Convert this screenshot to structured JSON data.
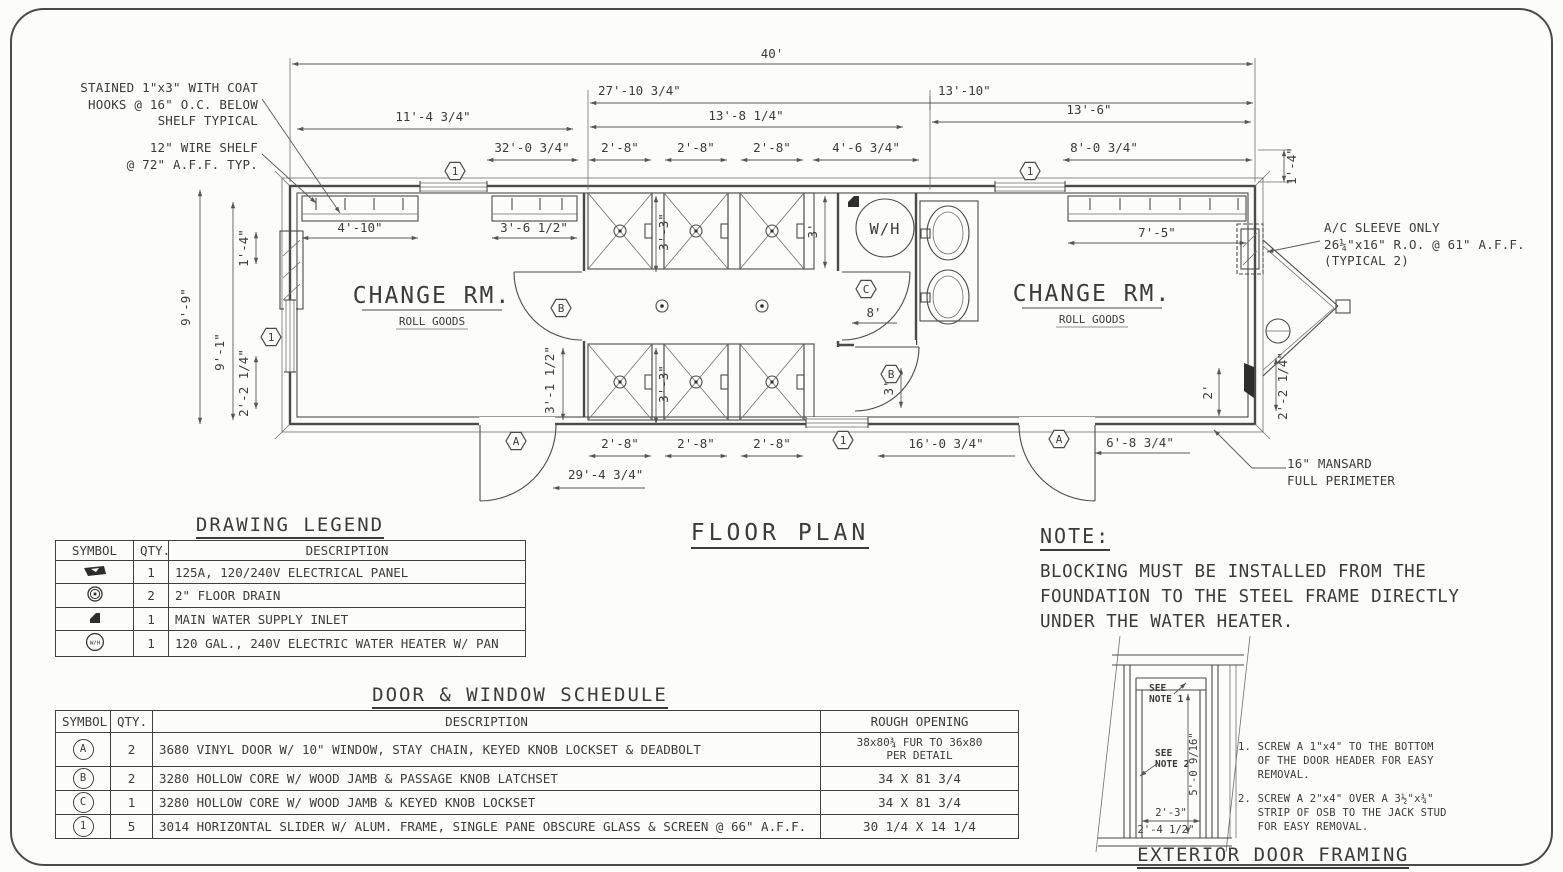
{
  "page": {
    "floor_plan_title": "FLOOR PLAN"
  },
  "callouts": {
    "coat_hooks": "STAINED 1\"x3\" WITH COAT\nHOOKS @ 16\" O.C. BELOW\nSHELF TYPICAL",
    "wire_shelf": "12\" WIRE SHELF\n@ 72\" A.F.F. TYP.",
    "ac_sleeve": "A/C SLEEVE ONLY\n26¼\"x16\" R.O. @ 61\" A.F.F.\n(TYPICAL 2)",
    "mansard": "16\" MANSARD\nFULL PERIMETER"
  },
  "plan": {
    "labels": {
      "wh": "W/H"
    },
    "rooms": [
      {
        "name": "CHANGE RM.",
        "sub": "ROLL GOODS"
      },
      {
        "name": "CHANGE RM.",
        "sub": "ROLL GOODS"
      }
    ],
    "markers": {
      "a": "A",
      "b": "B",
      "c": "C",
      "w1": "1"
    },
    "dims": {
      "d40": "40'",
      "d27_10": "27'-10 3/4\"",
      "d13_8": "13'-8 1/4\"",
      "d13_10": "13'-10\"",
      "d13_6": "13'-6\"",
      "d11_4": "11'-4 3/4\"",
      "d32_0": "32'-0 3/4\"",
      "d2_8": "2'-8\"",
      "d4_6": "4'-6 3/4\"",
      "d8_0": "8'-0 3/4\"",
      "d1_4": "1'-4\"",
      "d7_5": "7'-5\"",
      "d4_10": "4'-10\"",
      "d3_6": "3'-6 1/2\"",
      "d9_9": "9'-9\"",
      "d9_1": "9'-1\"",
      "d2_2": "2'-2 1/4\"",
      "d3_3": "3'-3\"",
      "d3": "3'",
      "d3_1": "3'-1 1/2\"",
      "d8": "8'",
      "d16_0": "16'-0 3/4\"",
      "d6_8": "6'-8 3/4\"",
      "d29_4": "29'-4 3/4\"",
      "d2": "2'"
    }
  },
  "legend": {
    "title": "DRAWING LEGEND",
    "headers": [
      "SYMBOL",
      "QTY.",
      "DESCRIPTION"
    ],
    "wh_symbol_label": "W/H",
    "rows": [
      {
        "symbol": "electrical-panel",
        "qty": "1",
        "description": "125A, 120/240V ELECTRICAL PANEL"
      },
      {
        "symbol": "floor-drain",
        "qty": "2",
        "description": "2\" FLOOR DRAIN"
      },
      {
        "symbol": "water-supply-inlet",
        "qty": "1",
        "description": "MAIN WATER SUPPLY INLET"
      },
      {
        "symbol": "water-heater",
        "qty": "1",
        "description": "120 GAL., 240V ELECTRIC WATER HEATER W/ PAN"
      }
    ]
  },
  "schedule": {
    "title": "DOOR & WINDOW SCHEDULE",
    "headers": [
      "SYMBOL",
      "QTY.",
      "DESCRIPTION",
      "ROUGH OPENING"
    ],
    "rows": [
      {
        "symbol": "A",
        "qty": "2",
        "description": "3680 VINYL DOOR W/ 10\" WINDOW, STAY CHAIN, KEYED KNOB LOCKSET & DEADBOLT",
        "rough_opening": "38x80¾ FUR TO 36x80\nPER DETAIL"
      },
      {
        "symbol": "B",
        "qty": "2",
        "description": "3280 HOLLOW CORE W/ WOOD JAMB & PASSAGE KNOB LATCHSET",
        "rough_opening": "34 X 81 3/4"
      },
      {
        "symbol": "C",
        "qty": "1",
        "description": "3280 HOLLOW CORE W/ WOOD JAMB & KEYED KNOB LOCKSET",
        "rough_opening": "34 X 81 3/4"
      },
      {
        "symbol": "1",
        "qty": "5",
        "description": "3014 HORIZONTAL SLIDER W/ ALUM. FRAME, SINGLE PANE OBSCURE GLASS & SCREEN @ 66\" A.F.F.",
        "rough_opening": "30 1/4 X 14 1/4"
      }
    ]
  },
  "note": {
    "title": "NOTE:",
    "body": "BLOCKING MUST BE INSTALLED FROM THE\nFOUNDATION TO THE STEEL FRAME DIRECTLY\nUNDER THE WATER HEATER."
  },
  "door_framing": {
    "title": "EXTERIOR DOOR FRAMING",
    "see_note_1": "SEE\nNOTE 1",
    "see_note_2": "SEE\nNOTE 2",
    "dims": {
      "height": "5'-0 9/16\"",
      "width_inner": "2'-3\"",
      "width_outer": "2'-4 1/2\""
    },
    "notes": [
      "1. SCREW A 1\"x4\" TO THE BOTTOM\n   OF THE DOOR HEADER FOR EASY\n   REMOVAL.",
      "2. SCREW A 2\"x4\" OVER A 3½\"x¾\"\n   STRIP OF OSB TO THE JACK STUD\n   FOR EASY REMOVAL."
    ]
  }
}
